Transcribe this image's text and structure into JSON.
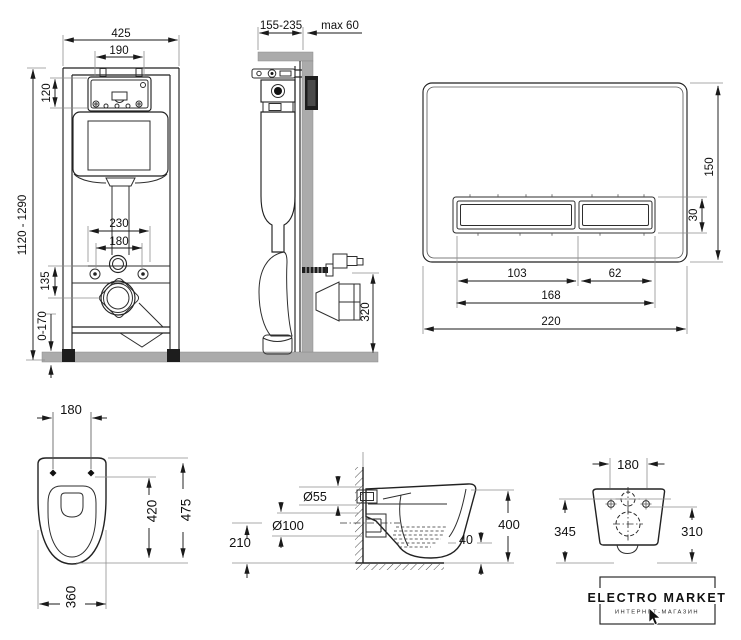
{
  "frame_front": {
    "dim_width": "425",
    "dim_opening_width": "190",
    "dim_opening_height": "120",
    "dim_height_range": "1120 - 1290",
    "dim_fixing_wide": "230",
    "dim_fixing_narrow": "180",
    "dim_outlet_offset": "135",
    "dim_leg_adjust": "0-170"
  },
  "frame_side": {
    "dim_depth_range": "155-235",
    "dim_wall_max": "max 60",
    "dim_outlet_height": "320"
  },
  "flush_plate": {
    "dim_height": "150",
    "dim_button_height": "30",
    "dim_button_left": "103",
    "dim_button_right": "62",
    "dim_buttons_total": "168",
    "dim_width": "220"
  },
  "toilet_top": {
    "dim_bolt_spacing": "180",
    "dim_length": "475",
    "dim_bowl_length": "420",
    "dim_width": "360"
  },
  "toilet_side": {
    "dim_inlet": "Ø55",
    "dim_outlet": "Ø100",
    "dim_outlet_height": "210",
    "dim_height": "400",
    "dim_gap": "40"
  },
  "toilet_back": {
    "dim_bolt_spacing": "180",
    "dim_height_left": "345",
    "dim_height_right": "310"
  },
  "logo": {
    "title": "ELECTRO MARKET",
    "subtitle": "ИНТЕРНЕТ-МАГАЗИН"
  },
  "colors": {
    "line": "#222222",
    "extension_line": "#8f8f8f",
    "wall_floor_gray": "#ababab",
    "background": "#ffffff"
  }
}
